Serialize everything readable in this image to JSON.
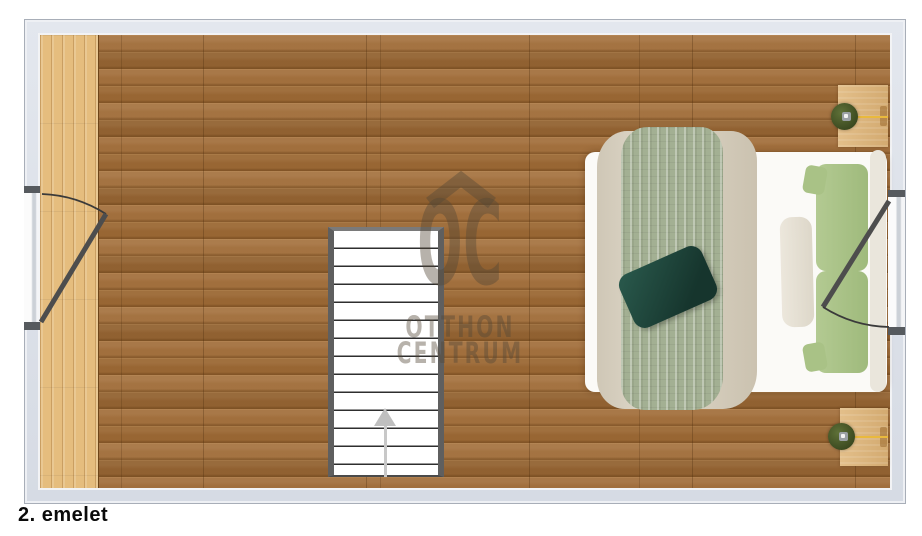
{
  "floor_plan": {
    "label": "2. emelet",
    "type": "top-down apartment floor plan"
  },
  "watermark": {
    "logo_text": "OC",
    "brand_line1": "OTTHON",
    "brand_line2": "CENTRUM",
    "roof_icon": "roof-chevron-icon",
    "color": "#54473a"
  },
  "palette": {
    "wall": "#dce0e8",
    "wall_border": "#a8aeb8",
    "floor_main_wood": "#a06b36",
    "floor_accent_wood": "#e5bd7e",
    "stair_rail": "#5f5f5f",
    "blanket_beige": "#d9d2c3",
    "blanket_green": "#a3b093",
    "pillow_teal": "#1d453c",
    "pillow_green": "#abc489",
    "pillow_cream": "#e6e1d6",
    "nightstand_wood": "#ddb883",
    "lamp_green": "#47552f",
    "lamp_cord_yellow": "#e9b93d"
  },
  "furniture": {
    "staircase": {
      "name": "staircase",
      "steps": 14,
      "direction": "up"
    },
    "bed": {
      "name": "double-bed"
    },
    "nightstands": [
      {
        "name": "nightstand-top",
        "lamp": "table-lamp"
      },
      {
        "name": "nightstand-bottom",
        "lamp": "table-lamp"
      }
    ],
    "openings": [
      {
        "side": "left",
        "type": "balcony-door-swing"
      },
      {
        "side": "right",
        "type": "balcony-door-swing"
      }
    ]
  }
}
